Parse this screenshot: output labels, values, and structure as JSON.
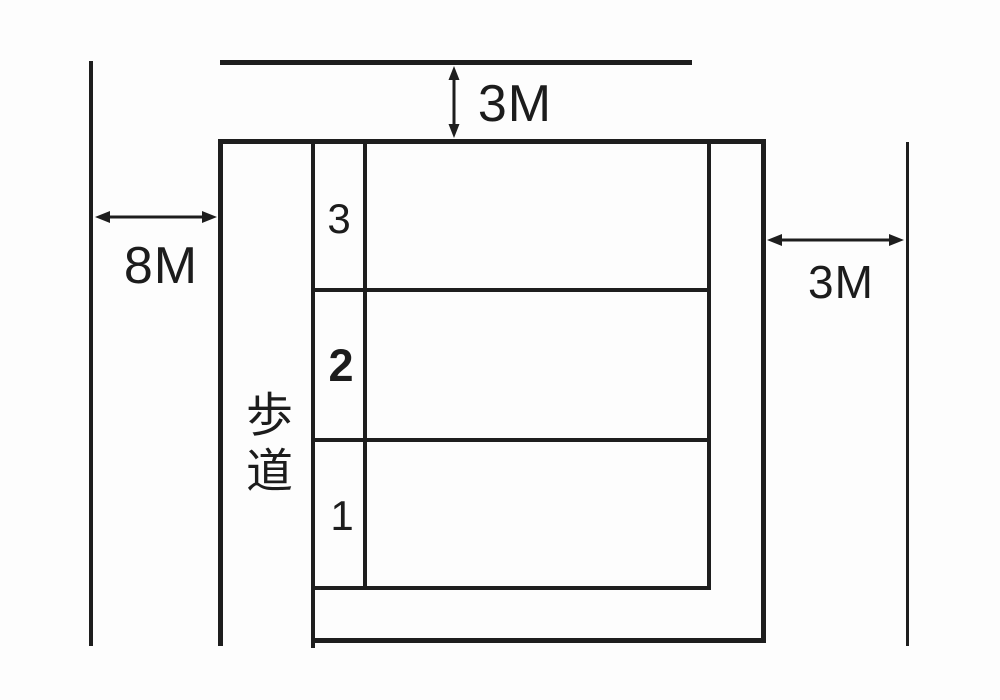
{
  "diagram": {
    "kind": "site-plan-sketch",
    "background_color": "#fdfdfd",
    "line_color": "#1e1e1e",
    "dimensions": {
      "top": {
        "label": "3M",
        "arrow": "double-headed-vertical-arrow"
      },
      "left": {
        "label": "8M",
        "arrow": "double-headed-horizontal-arrow"
      },
      "right": {
        "label": "3M",
        "arrow": "double-headed-horizontal-arrow"
      }
    },
    "sidewalk": {
      "label": "歩道"
    },
    "sections": [
      {
        "number": "3"
      },
      {
        "number": "2"
      },
      {
        "number": "1"
      }
    ]
  }
}
